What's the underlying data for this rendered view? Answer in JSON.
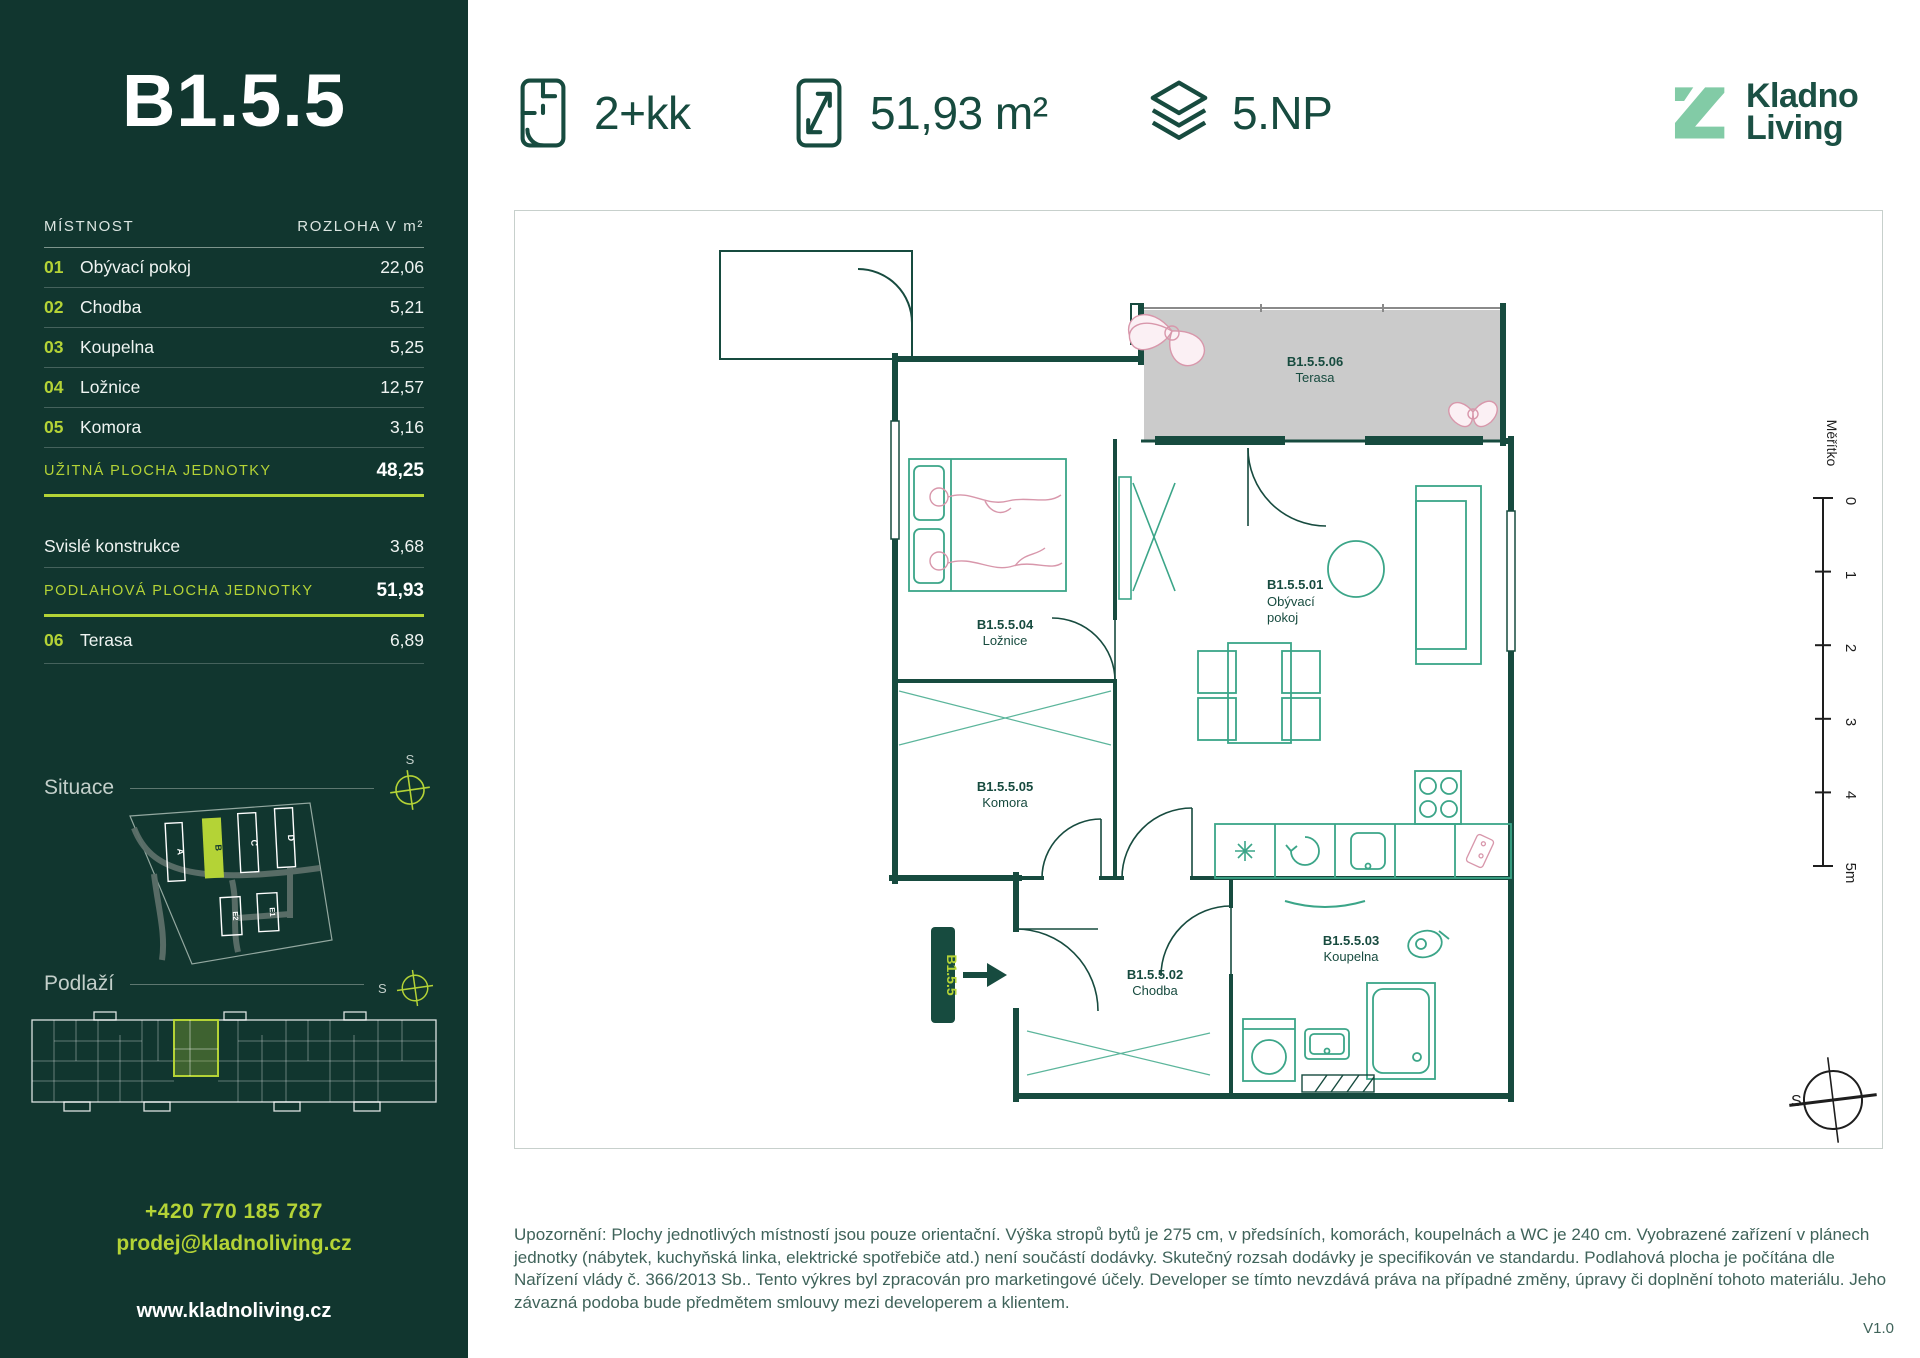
{
  "unit": {
    "code": "B1.5.5",
    "layout": "2+kk",
    "area": "51,93 m²",
    "floor": "5.NP"
  },
  "logo": {
    "line1": "Kladno",
    "line2": "Living"
  },
  "table": {
    "header": {
      "room": "MÍSTNOST",
      "area": "ROZLOHA V m²"
    },
    "rows": [
      {
        "num": "01",
        "name": "Obývací pokoj",
        "value": "22,06"
      },
      {
        "num": "02",
        "name": "Chodba",
        "value": "5,21"
      },
      {
        "num": "03",
        "name": "Koupelna",
        "value": "5,25"
      },
      {
        "num": "04",
        "name": "Ložnice",
        "value": "12,57"
      },
      {
        "num": "05",
        "name": "Komora",
        "value": "3,16"
      }
    ],
    "subtotal": {
      "label": "UŽITNÁ PLOCHA JEDNOTKY",
      "value": "48,25"
    },
    "construction": {
      "name": "Svislé konstrukce",
      "value": "3,68"
    },
    "total": {
      "label": "PODLAHOVÁ PLOCHA JEDNOTKY",
      "value": "51,93"
    },
    "terrace": {
      "num": "06",
      "name": "Terasa",
      "value": "6,89"
    }
  },
  "situace": {
    "label": "Situace",
    "compass": "S",
    "buildings": [
      "A",
      "B",
      "C",
      "D",
      "E2",
      "E1"
    ],
    "highlighted": "B"
  },
  "podlazi": {
    "label": "Podlaží",
    "compass": "S"
  },
  "contact": {
    "phone": "+420 770 185 787",
    "email": "prodej@kladnoliving.cz",
    "web": "www.kladnoliving.cz"
  },
  "plan": {
    "rooms": {
      "terasa": {
        "code": "B1.5.5.06",
        "name": "Terasa"
      },
      "obyvaci": {
        "code": "B1.5.5.01",
        "name1": "Obývací",
        "name2": "pokoj"
      },
      "loznice": {
        "code": "B1.5.5.04",
        "name": "Ložnice"
      },
      "komora": {
        "code": "B1.5.5.05",
        "name": "Komora"
      },
      "chodba": {
        "code": "B1.5.5.02",
        "name": "Chodba"
      },
      "koupelna": {
        "code": "B1.5.5.03",
        "name": "Koupelna"
      }
    },
    "entrance_badge": "B1.5.5",
    "scale": {
      "label": "Měřítko",
      "ticks": [
        "0",
        "1",
        "2",
        "3",
        "4",
        "5m"
      ]
    },
    "compass": "S"
  },
  "footer": {
    "disclaimer": "Upozornění: Plochy jednotlivých místností jsou pouze orientační. Výška stropů bytů je 275 cm, v předsíních, komorách, koupelnách a WC je 240 cm. Vyobrazené zařízení v plánech jednotky (nábytek, kuchyňská linka, elektrické spotřebiče atd.) není součástí dodávky. Skutečný rozsah dodávky je specifikován ve standardu. Podlahová plocha je počítána dle Nařízení vlády č. 366/2013 Sb.. Tento výkres byl zpracován pro marketingové účely. Developer se tímto nevzdává práva na případné změny, úpravy či doplnění tohoto materiálu. Jeho závazná podoba bude předmětem smlouvy mezi developerem a klientem.",
    "version": "V1.0"
  },
  "colors": {
    "sidebar_bg": "#11362F",
    "accent": "#B4D336",
    "dark_green": "#174B3F",
    "logo_mint": "#82CBA6"
  }
}
